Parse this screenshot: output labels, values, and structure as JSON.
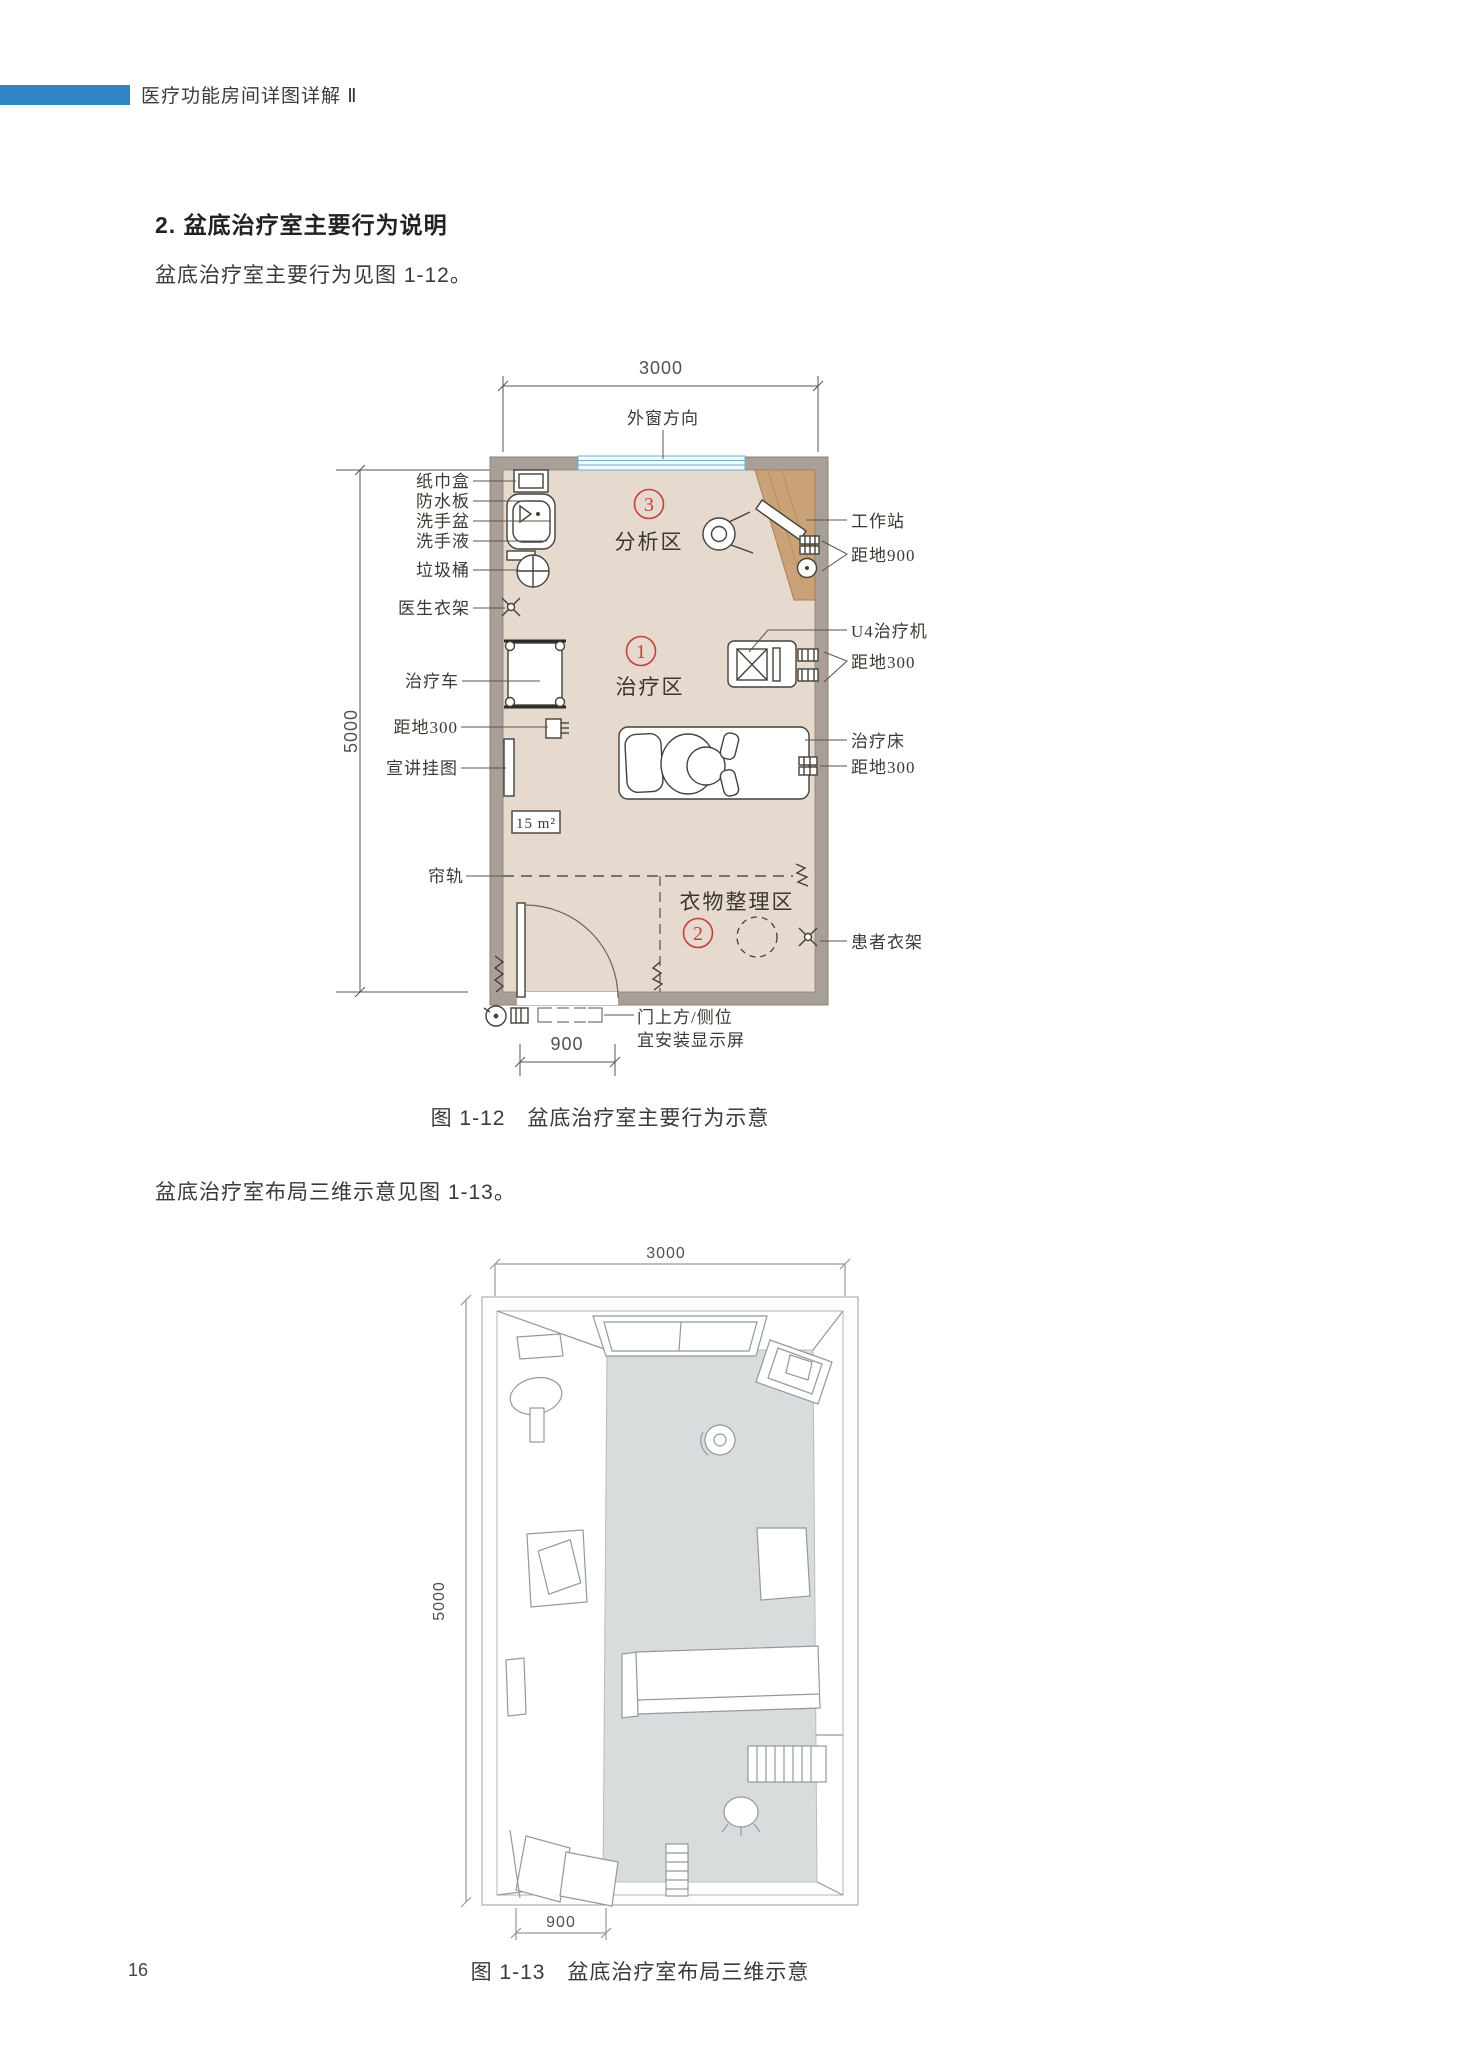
{
  "page": {
    "number": "16"
  },
  "header": {
    "title": "医疗功能房间详图详解 Ⅱ"
  },
  "section": {
    "heading": "2. 盆底治疗室主要行为说明",
    "para1": "盆底治疗室主要行为见图 1-12。",
    "para2": "盆底治疗室布局三维示意见图 1-13。"
  },
  "colors": {
    "accent_blue": "#2e86c4",
    "zone_red": "#c6403c",
    "wall_gray": "#a89f98",
    "floor_beige": "#e6d9cd",
    "desk_wood": "#c9a277",
    "window_blue": "#74aec6"
  },
  "fig12": {
    "caption": "图 1-12　盆底治疗室主要行为示意",
    "dim_top": "3000",
    "dim_left": "5000",
    "dim_door": "900",
    "window_label": "外窗方向",
    "area_label": "15 m²",
    "zones": [
      {
        "num": "3",
        "name": "分析区"
      },
      {
        "num": "1",
        "name": "治疗区"
      },
      {
        "num": "2",
        "name": "衣物整理区"
      }
    ],
    "left_labels": [
      "纸巾盒",
      "防水板",
      "洗手盆",
      "洗手液",
      "垃圾桶",
      "医生衣架",
      "治疗车",
      "距地300",
      "宣讲挂图",
      "帘轨"
    ],
    "right_labels": [
      "工作站",
      "距地900",
      "U4治疗机",
      "距地300",
      "治疗床",
      "距地300",
      "患者衣架"
    ],
    "door_note": [
      "门上方/侧位",
      "宜安装显示屏"
    ]
  },
  "fig13": {
    "caption": "图 1-13　盆底治疗室布局三维示意",
    "dim_top": "3000",
    "dim_left": "5000",
    "dim_door": "900"
  }
}
